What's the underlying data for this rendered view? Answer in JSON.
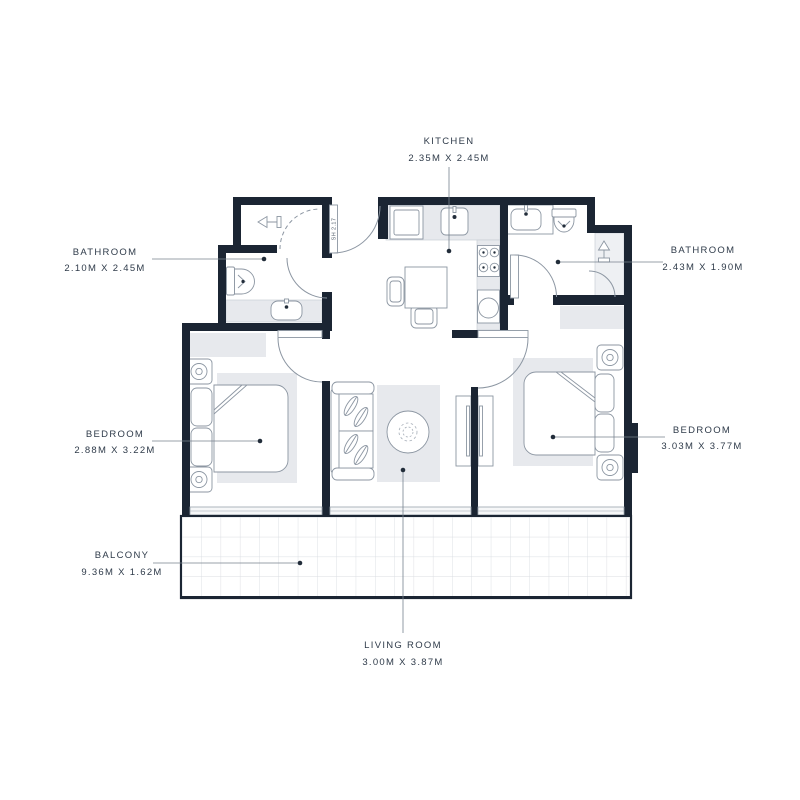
{
  "page": {
    "background": "#ffffff"
  },
  "floor_plan": {
    "door_size_label": "SH 2.17",
    "labels": {
      "kitchen": {
        "name": "KITCHEN",
        "dims": "2.35M X 2.45M"
      },
      "bathroom_left": {
        "name": "BATHROOM",
        "dims": "2.10M X 2.45M"
      },
      "bathroom_right": {
        "name": "BATHROOM",
        "dims": "2.43M X 1.90M"
      },
      "bedroom_left": {
        "name": "BEDROOM",
        "dims": "2.88M X 3.22M"
      },
      "bedroom_right": {
        "name": "BEDROOM",
        "dims": "3.03M X 3.77M"
      },
      "balcony": {
        "name": "BALCONY",
        "dims": "9.36M X 1.62M"
      },
      "living_room": {
        "name": "LIVING ROOM",
        "dims": "3.00M X 3.87M"
      }
    },
    "colors": {
      "wall": "#1b2533",
      "counter_fill": "#e7e9ed",
      "shower_tile_fill": "#eef0f3",
      "furniture_line": "#8c96a2",
      "label_text": "#2f3b4a",
      "leader_line": "#77828e",
      "balcony_grid": "#dadde2"
    },
    "icons": [
      "shower-icon",
      "toilet-icon",
      "sink-icon",
      "stove-icon",
      "washer-icon",
      "lamp-icon",
      "tv-icon"
    ]
  }
}
